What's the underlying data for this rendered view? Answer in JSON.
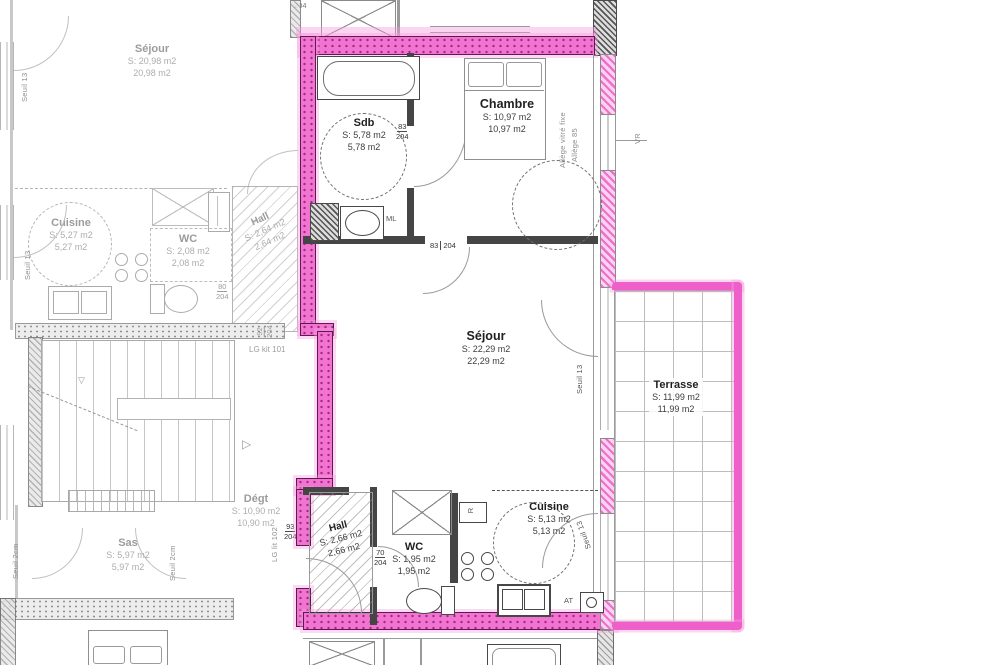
{
  "title": "Floor plan — apartment T2 with terrace (highlighted unit)",
  "colors": {
    "highlight_pink": "#f175d0",
    "highlight_dot": "#a82689",
    "overspray_pink": "#f699de",
    "wall_gray": "#9f9f9f",
    "main_text": "#1f1f1f",
    "faded_text": "#9c9c9c"
  },
  "left_unit": {
    "sejour": {
      "name": "Séjour",
      "s": "S: 20,98 m2",
      "a": "20,98 m2"
    },
    "cuisine": {
      "name": "Cuisine",
      "s": "S: 5,27 m2",
      "a": "5,27 m2"
    },
    "wc": {
      "name": "WC",
      "s": "S: 2,08 m2",
      "a": "2,08 m2"
    },
    "hall": {
      "name": "Hall",
      "s": "S: 2,64 m2",
      "a": "2,64 m2"
    },
    "degt": {
      "name": "Dégt",
      "s": "S: 10,90 m2",
      "a": "10,90 m2"
    },
    "sas": {
      "name": "Sas",
      "s": "S: 5,97 m2",
      "a": "5,97 m2"
    },
    "labels": {
      "seuil13_top": "Seuil 13",
      "seuil13_cuisine": "Seuil 13",
      "seuil2cm_left": "Seuil 2cm",
      "seuil2cm_right": "Seuil 2cm",
      "lg_kit": "LG kit 101"
    },
    "dims": {
      "d80": {
        "w": "80",
        "h": "204"
      },
      "d92": {
        "w": "92",
        "h": "204"
      }
    }
  },
  "main_unit": {
    "sdb": {
      "name": "Sdb",
      "s": "S: 5,78 m2",
      "a": "5,78 m2"
    },
    "chambre": {
      "name": "Chambre",
      "s": "S: 10,97 m2",
      "a": "10,97 m2"
    },
    "sejour": {
      "name": "Séjour",
      "s": "S: 22,29 m2",
      "a": "22,29 m2"
    },
    "hall": {
      "name": "Hall",
      "s": "S: 2,66 m2",
      "a": "2,66 m2"
    },
    "wc": {
      "name": "WC",
      "s": "S: 1,95 m2",
      "a": "1,95 m2"
    },
    "cuisine": {
      "name": "Cuisine",
      "s": "S: 5,13 m2",
      "a": "5,13 m2"
    },
    "labels": {
      "ml": "ML",
      "r": "R",
      "at": "AT",
      "allege_line1": "Allège vitré fixe",
      "allege_line2": "Allège 85",
      "vr_chambre": "VR",
      "vr_terrace_top": "VR",
      "vr_terrace_bottom": "VR",
      "seuil13_sejour": "Seuil 13",
      "seuil13_cuisine": "Seuil 13",
      "lg_lit": "LG lit 102",
      "top_dim": "204"
    },
    "dims": {
      "d83_sdb": {
        "w": "83",
        "h": "204"
      },
      "d83_sejour": {
        "w": "83",
        "h": "204"
      },
      "d93_entrance": {
        "w": "93",
        "h": "204"
      },
      "d70_wc": {
        "w": "70",
        "h": "204"
      }
    }
  },
  "terrace": {
    "name": "Terrasse",
    "s": "S: 11,99 m2",
    "a": "11,99 m2"
  }
}
